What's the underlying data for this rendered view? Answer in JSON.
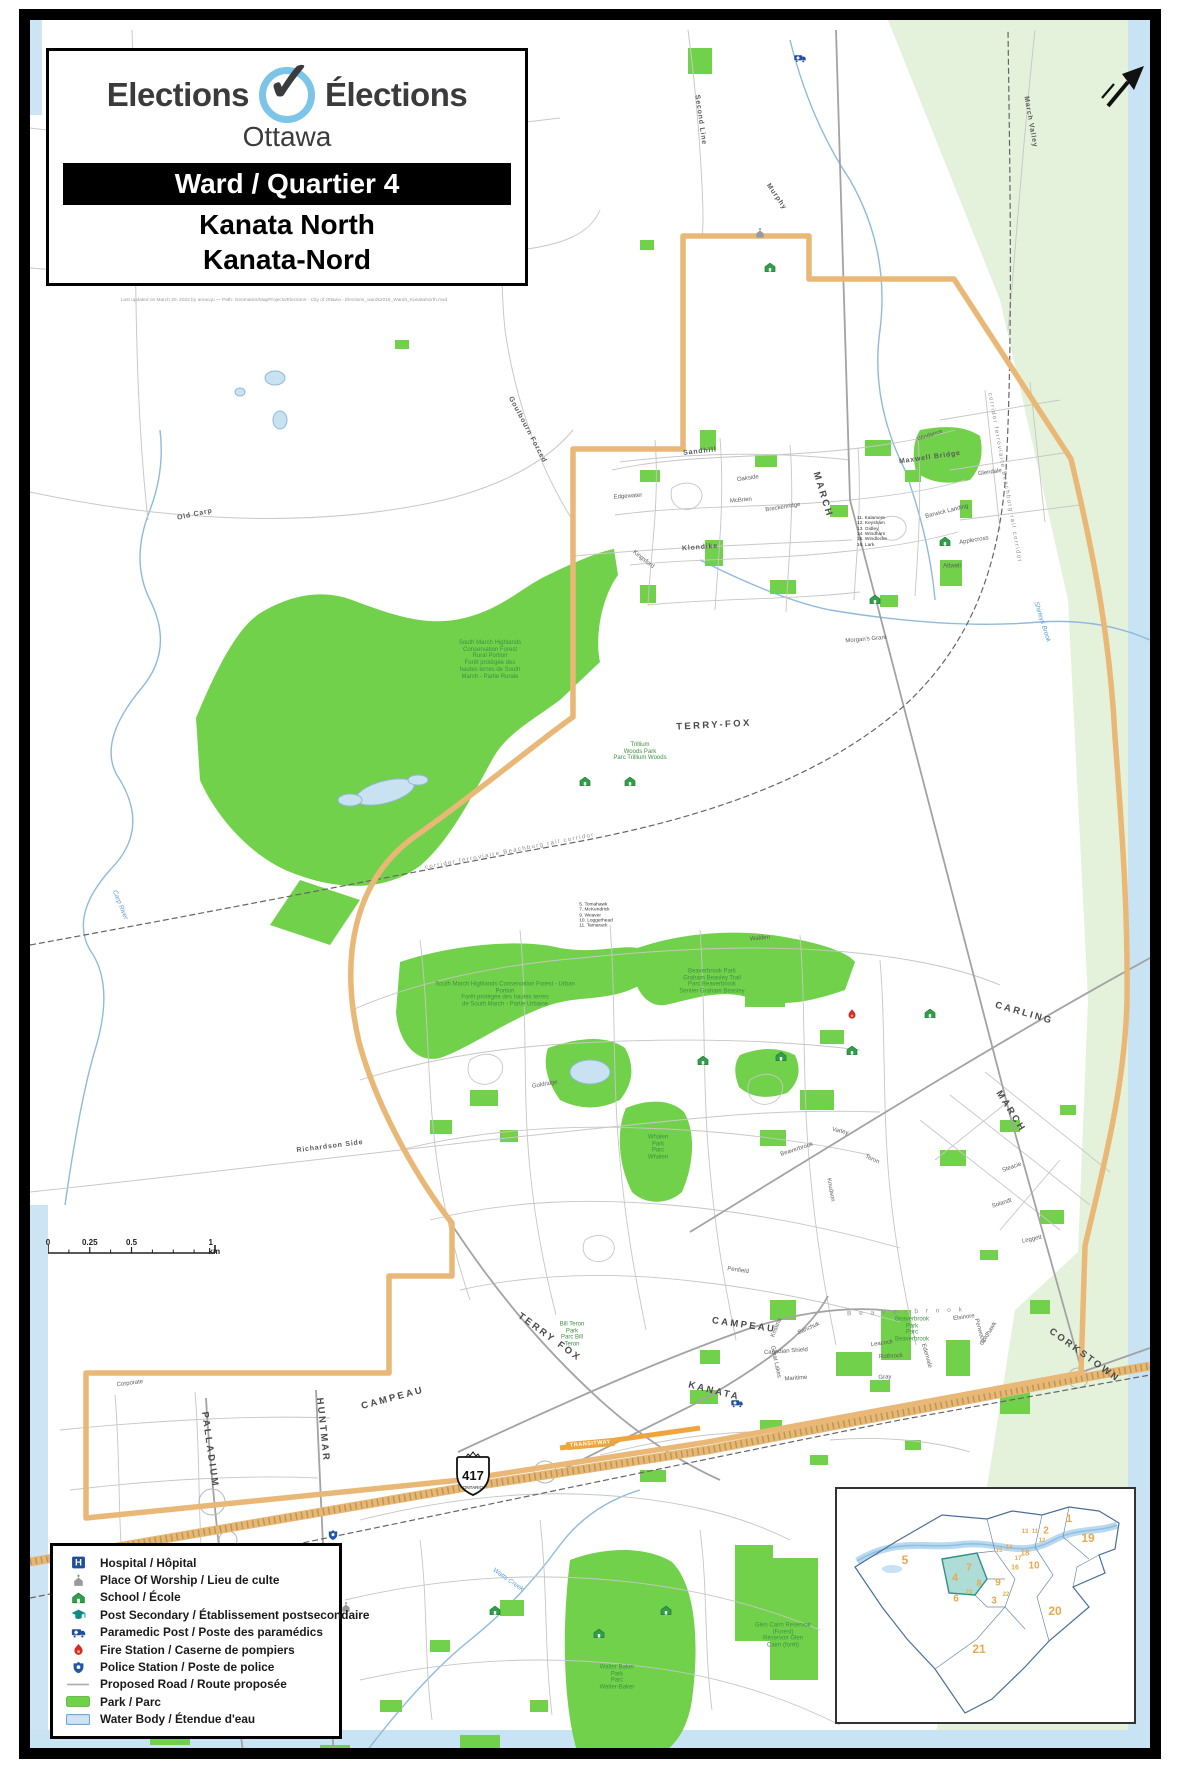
{
  "colors": {
    "boundary": "#E9B877",
    "park_green": "#72D14B",
    "greenbelt_pale": "#E4F2DC",
    "water_fill": "#CDE4F5",
    "water_stroke": "#8FBADC",
    "road_gray": "#BDBDBD",
    "park_label_green": "#3F9142",
    "inset_number_orange": "#E8A94F",
    "logo_blue": "#7CC5E8",
    "banner_black": "#000000",
    "highway_tan": "#E7B873"
  },
  "title_block": {
    "logo_en": "Elections",
    "logo_fr": "Élections",
    "logo_city": "Ottawa",
    "ward_banner": "Ward / Quartier 4",
    "ward_name_en": "Kanata North",
    "ward_name_fr": "Kanata-Nord",
    "caption": "Last updated on March 30, 2022 by amacqu — Path: Geomatics/MapProjects/Elections - City of Ottawa - Elections_wards2018_Ward4_KanataNorth.mxd"
  },
  "scale_bar": {
    "ticks": [
      {
        "label": "0",
        "pos": 0
      },
      {
        "label": "0.25",
        "pos": 0.25
      },
      {
        "label": "0.5",
        "pos": 0.5
      },
      {
        "label": "1 km",
        "pos": 1
      }
    ]
  },
  "highway_shield": {
    "number": "417",
    "province": "ONTARIO"
  },
  "transitway": {
    "label": "TRANSITWAY"
  },
  "legend": {
    "items": [
      {
        "icon": "hospital-icon",
        "label": "Hospital / Hôpital"
      },
      {
        "icon": "worship-icon",
        "label": "Place Of Worship / Lieu de culte"
      },
      {
        "icon": "school-icon",
        "label": "School / École"
      },
      {
        "icon": "postsecondary-icon",
        "label": "Post Secondary / Établissement postsecondaire"
      },
      {
        "icon": "paramedic-icon",
        "label": "Paramedic Post / Poste des paramédics"
      },
      {
        "icon": "fire-icon",
        "label": "Fire Station / Caserne de pompiers"
      },
      {
        "icon": "police-icon",
        "label": "Police Station / Poste de police"
      },
      {
        "icon": "proposed-road-icon",
        "label": "Proposed Road / Route proposée"
      },
      {
        "icon": "park-icon",
        "label": "Park / Parc"
      },
      {
        "icon": "water-icon",
        "label": "Water Body / Étendue d'eau"
      }
    ]
  },
  "inset": {
    "highlight_ward": "4",
    "numbers": [
      {
        "n": "1",
        "x": 232,
        "y": 30,
        "s": 11
      },
      {
        "n": "2",
        "x": 209,
        "y": 42,
        "s": 10
      },
      {
        "n": "19",
        "x": 251,
        "y": 49,
        "s": 12
      },
      {
        "n": "5",
        "x": 68,
        "y": 71,
        "s": 12
      },
      {
        "n": "7",
        "x": 132,
        "y": 79,
        "s": 10
      },
      {
        "n": "4",
        "x": 118,
        "y": 89,
        "s": 11
      },
      {
        "n": "8",
        "x": 142,
        "y": 94,
        "s": 9
      },
      {
        "n": "9",
        "x": 161,
        "y": 94,
        "s": 10
      },
      {
        "n": "10",
        "x": 197,
        "y": 77,
        "s": 10
      },
      {
        "n": "18",
        "x": 188,
        "y": 64,
        "s": 8
      },
      {
        "n": "16",
        "x": 178,
        "y": 79,
        "s": 7
      },
      {
        "n": "15",
        "x": 162,
        "y": 62,
        "s": 6
      },
      {
        "n": "14",
        "x": 172,
        "y": 59,
        "s": 6
      },
      {
        "n": "13",
        "x": 188,
        "y": 43,
        "s": 6
      },
      {
        "n": "11",
        "x": 198,
        "y": 43,
        "s": 6
      },
      {
        "n": "17",
        "x": 181,
        "y": 70,
        "s": 6
      },
      {
        "n": "12",
        "x": 205,
        "y": 52,
        "s": 6
      },
      {
        "n": "23",
        "x": 132,
        "y": 104,
        "s": 6
      },
      {
        "n": "3",
        "x": 157,
        "y": 112,
        "s": 10
      },
      {
        "n": "22",
        "x": 169,
        "y": 106,
        "s": 6
      },
      {
        "n": "6",
        "x": 119,
        "y": 110,
        "s": 10
      },
      {
        "n": "20",
        "x": 218,
        "y": 122,
        "s": 12
      },
      {
        "n": "21",
        "x": 142,
        "y": 160,
        "s": 12
      }
    ]
  },
  "map_labels": [
    {
      "t": "MARCH",
      "x": 822,
      "y": 495,
      "r": 73,
      "c": "road"
    },
    {
      "t": "MARCH",
      "x": 1010,
      "y": 1112,
      "r": 58,
      "c": "road"
    },
    {
      "t": "TERRY-FOX",
      "x": 714,
      "y": 726,
      "r": -3,
      "c": "road"
    },
    {
      "t": "TERRY FOX",
      "x": 549,
      "y": 1338,
      "r": 36,
      "c": "road"
    },
    {
      "t": "CARLING",
      "x": 1024,
      "y": 1014,
      "r": 16,
      "c": "road"
    },
    {
      "t": "CAMPEAU",
      "x": 744,
      "y": 1326,
      "r": 8,
      "c": "road"
    },
    {
      "t": "CAMPEAU",
      "x": 393,
      "y": 1399,
      "r": -15,
      "c": "road"
    },
    {
      "t": "KANATA",
      "x": 714,
      "y": 1392,
      "r": 14,
      "c": "road"
    },
    {
      "t": "CORKSTOWN",
      "x": 1084,
      "y": 1356,
      "r": 36,
      "c": "road"
    },
    {
      "t": "HUNTMAR",
      "x": 322,
      "y": 1430,
      "r": 84,
      "c": "road"
    },
    {
      "t": "PALLADIUM",
      "x": 209,
      "y": 1450,
      "r": 82,
      "c": "road"
    },
    {
      "t": "Richardson Side",
      "x": 330,
      "y": 1147,
      "r": -7,
      "c": "road-sm"
    },
    {
      "t": "Murphy",
      "x": 776,
      "y": 197,
      "r": 55,
      "c": "road-sm"
    },
    {
      "t": "Sandhill",
      "x": 700,
      "y": 452,
      "r": -6,
      "c": "road-sm"
    },
    {
      "t": "March Valley",
      "x": 1030,
      "y": 122,
      "r": 80,
      "c": "road-sm"
    },
    {
      "t": "Old Carp",
      "x": 195,
      "y": 515,
      "r": -12,
      "c": "road-sm"
    },
    {
      "t": "Maxwell Bridge",
      "x": 930,
      "y": 458,
      "r": -8,
      "c": "road-sm"
    },
    {
      "t": "Klondike",
      "x": 700,
      "y": 548,
      "r": -4,
      "c": "road-sm"
    },
    {
      "t": "Goulbourn Forced",
      "x": 527,
      "y": 430,
      "r": 62,
      "c": "road-sm"
    },
    {
      "t": "Second Line",
      "x": 700,
      "y": 120,
      "r": 82,
      "c": "road-sm"
    },
    {
      "t": "corridor ferroviaire Beachburg rail corridor",
      "x": 510,
      "y": 852,
      "r": -11,
      "c": "rail"
    },
    {
      "t": "corridor ferroviaire Beachburg rail corridor",
      "x": 1004,
      "y": 478,
      "r": 80,
      "c": "rail"
    },
    {
      "t": "Oakside",
      "x": 748,
      "y": 479,
      "r": -8,
      "c": "street"
    },
    {
      "t": "McBrien",
      "x": 741,
      "y": 501,
      "r": -5,
      "c": "street"
    },
    {
      "t": "Breckenridge",
      "x": 783,
      "y": 508,
      "r": -9,
      "c": "street"
    },
    {
      "t": "Edgewater",
      "x": 628,
      "y": 497,
      "r": -4,
      "c": "street"
    },
    {
      "t": "Kingsford",
      "x": 643,
      "y": 560,
      "r": 38,
      "c": "street"
    },
    {
      "t": "Windance",
      "x": 930,
      "y": 436,
      "r": -18,
      "c": "street"
    },
    {
      "t": "Barwick Landing",
      "x": 947,
      "y": 512,
      "r": -14,
      "c": "street"
    },
    {
      "t": "Glendale",
      "x": 990,
      "y": 473,
      "r": -8,
      "c": "street"
    },
    {
      "t": "Applecross",
      "x": 974,
      "y": 541,
      "r": -9,
      "c": "street"
    },
    {
      "t": "Attwell",
      "x": 952,
      "y": 567,
      "r": 0,
      "c": "street"
    },
    {
      "t": "Morgan's Grant",
      "x": 866,
      "y": 640,
      "r": -5,
      "c": "street"
    },
    {
      "t": "Knudson",
      "x": 830,
      "y": 1190,
      "r": 80,
      "c": "street"
    },
    {
      "t": "Teron",
      "x": 872,
      "y": 1160,
      "r": 24,
      "c": "street"
    },
    {
      "t": "Beaverbrook",
      "x": 797,
      "y": 1150,
      "r": -18,
      "c": "street"
    },
    {
      "t": "Varley",
      "x": 840,
      "y": 1132,
      "r": 14,
      "c": "street"
    },
    {
      "t": "Penfield",
      "x": 738,
      "y": 1271,
      "r": 8,
      "c": "street"
    },
    {
      "t": "Solandt",
      "x": 1002,
      "y": 1204,
      "r": -18,
      "c": "street"
    },
    {
      "t": "Leggett",
      "x": 1032,
      "y": 1240,
      "r": -12,
      "c": "street"
    },
    {
      "t": "Steacie",
      "x": 1012,
      "y": 1168,
      "r": -20,
      "c": "street"
    },
    {
      "t": "Walden",
      "x": 760,
      "y": 939,
      "r": -5,
      "c": "street"
    },
    {
      "t": "Goldridge",
      "x": 545,
      "y": 1085,
      "r": -10,
      "c": "street"
    },
    {
      "t": "Corporate",
      "x": 130,
      "y": 1384,
      "r": -7,
      "c": "street"
    },
    {
      "t": "Canadian Shield",
      "x": 786,
      "y": 1352,
      "r": -4,
      "c": "street"
    },
    {
      "t": "Maritime",
      "x": 796,
      "y": 1379,
      "r": -4,
      "c": "street"
    },
    {
      "t": "Great Lakes",
      "x": 775,
      "y": 1362,
      "r": 78,
      "c": "street"
    },
    {
      "t": "Sanchuk",
      "x": 809,
      "y": 1329,
      "r": -24,
      "c": "street"
    },
    {
      "t": "Kristina",
      "x": 777,
      "y": 1328,
      "r": -68,
      "c": "street"
    },
    {
      "t": "Leacock",
      "x": 882,
      "y": 1344,
      "r": -8,
      "c": "street"
    },
    {
      "t": "Edenvale",
      "x": 926,
      "y": 1356,
      "r": 74,
      "c": "street"
    },
    {
      "t": "Rothrock",
      "x": 891,
      "y": 1357,
      "r": -3,
      "c": "street"
    },
    {
      "t": "Gray",
      "x": 885,
      "y": 1378,
      "r": -3,
      "c": "street"
    },
    {
      "t": "Penwood",
      "x": 979,
      "y": 1331,
      "r": 74,
      "c": "street"
    },
    {
      "t": "Goldhawk",
      "x": 989,
      "y": 1334,
      "r": -58,
      "c": "street"
    },
    {
      "t": "Elsinore",
      "x": 964,
      "y": 1318,
      "r": -8,
      "c": "street"
    },
    {
      "t": "Carp River",
      "x": 120,
      "y": 905,
      "r": 68,
      "c": "water"
    },
    {
      "t": "Shirleys Brook",
      "x": 1042,
      "y": 622,
      "r": 72,
      "c": "water"
    },
    {
      "t": "Watts Creek",
      "x": 508,
      "y": 1580,
      "r": 35,
      "c": "water"
    },
    {
      "t": "South March Highlands\nConservation Forest\nRural Portion\nForêt protégée des\nhautes terres de South\nMarch - Partie Rurale",
      "x": 490,
      "y": 660,
      "r": 0,
      "c": "park"
    },
    {
      "t": "Trillium\nWoods Park\nParc Trillium Woods",
      "x": 640,
      "y": 752,
      "r": 0,
      "c": "park"
    },
    {
      "t": "South March Highlands Conservation Forest - Urban\nPortion\nForêt protégée des hautes terres\nde South March - Partie Urbaine",
      "x": 505,
      "y": 995,
      "r": 0,
      "c": "park"
    },
    {
      "t": "Beaverbrook Park\nGraham Beasley Trail\nParc Beaverbrook\nSentier Graham Beasley",
      "x": 712,
      "y": 982,
      "r": 0,
      "c": "park"
    },
    {
      "t": "Whalen\nPark\nParc\nWhalen",
      "x": 658,
      "y": 1148,
      "r": 0,
      "c": "park"
    },
    {
      "t": "Bill Teron\nPark\nParc Bill\nTeron",
      "x": 572,
      "y": 1335,
      "r": 0,
      "c": "park"
    },
    {
      "t": "Beaverbrook\nPark\nParc\nBeaverbrook",
      "x": 912,
      "y": 1330,
      "r": 0,
      "c": "park"
    },
    {
      "t": "Walter Baker\nPark\nParc\nWalter-Baker",
      "x": 617,
      "y": 1678,
      "r": 0,
      "c": "park"
    },
    {
      "t": "Glen Cairn Reservoir\n(Forest)\nRéservoir Glen\nCairn (forêt)",
      "x": 783,
      "y": 1636,
      "r": 0,
      "c": "park"
    },
    {
      "t": "11. Kalamere\n12. Keysham\n13. Gidley\n14. Windham\n15. Windlocke\n16. Lark",
      "x": 872,
      "y": 532,
      "r": 0,
      "c": "tiny"
    },
    {
      "t": "5. Tomahawk\n7. McKendrick\n9. Weaver\n10. Loggerhead\n11. Tamarack",
      "x": 596,
      "y": 916,
      "r": 0,
      "c": "tiny"
    },
    {
      "t": "B e a v e r b r o o k",
      "x": 906,
      "y": 1312,
      "r": -2,
      "c": "area"
    }
  ],
  "markers": {
    "school": [
      [
        770,
        267
      ],
      [
        585,
        781
      ],
      [
        630,
        781
      ],
      [
        875,
        599
      ],
      [
        945,
        541
      ],
      [
        781,
        1056
      ],
      [
        852,
        1050
      ],
      [
        703,
        1060
      ],
      [
        930,
        1013
      ],
      [
        666,
        1610
      ],
      [
        599,
        1633
      ],
      [
        495,
        1610
      ]
    ],
    "worship": [
      [
        760,
        233
      ],
      [
        346,
        1607
      ]
    ],
    "paramedic": [
      [
        800,
        58
      ],
      [
        737,
        1403
      ]
    ],
    "fire": [
      [
        852,
        1014
      ]
    ],
    "police": [
      [
        333,
        1535
      ]
    ]
  }
}
